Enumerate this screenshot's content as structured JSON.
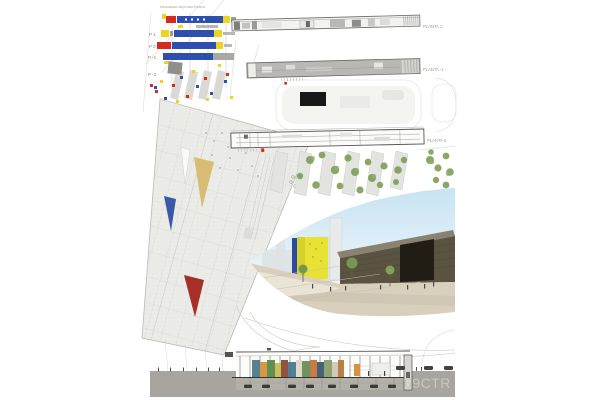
{
  "poster": {
    "program_diagram": {
      "title": "PROGRAMA ARQUITECTÓNICO",
      "levels": [
        {
          "label": "P 1"
        },
        {
          "label": "P 0"
        },
        {
          "label": "P -1"
        },
        {
          "label": "P -2"
        }
      ]
    },
    "plans": [
      {
        "label": "PLANTA 1"
      },
      {
        "label": "PLANTA -1"
      },
      {
        "label": "PLANTA 0"
      }
    ],
    "footer": {
      "project_code": "69CTR"
    },
    "palette": {
      "program_blue": "#2e4fae",
      "program_red": "#d42a1f",
      "program_yellow": "#edd41e",
      "program_gray": "#9c9c98",
      "roof_fill": "#ebebe8",
      "roof_triangle_tan": "#d9bc74",
      "roof_triangle_blue": "#3a5aa6",
      "roof_triangle_red": "#a63028",
      "render_yellow_building": "#e8e234",
      "render_dark_building": "#5a5342",
      "tree_green": "#7f9e58",
      "ground_beige": "#d8d0bd",
      "band_gray": "#a8a5a0",
      "footer_text_gray": "#c9c6c0"
    }
  }
}
